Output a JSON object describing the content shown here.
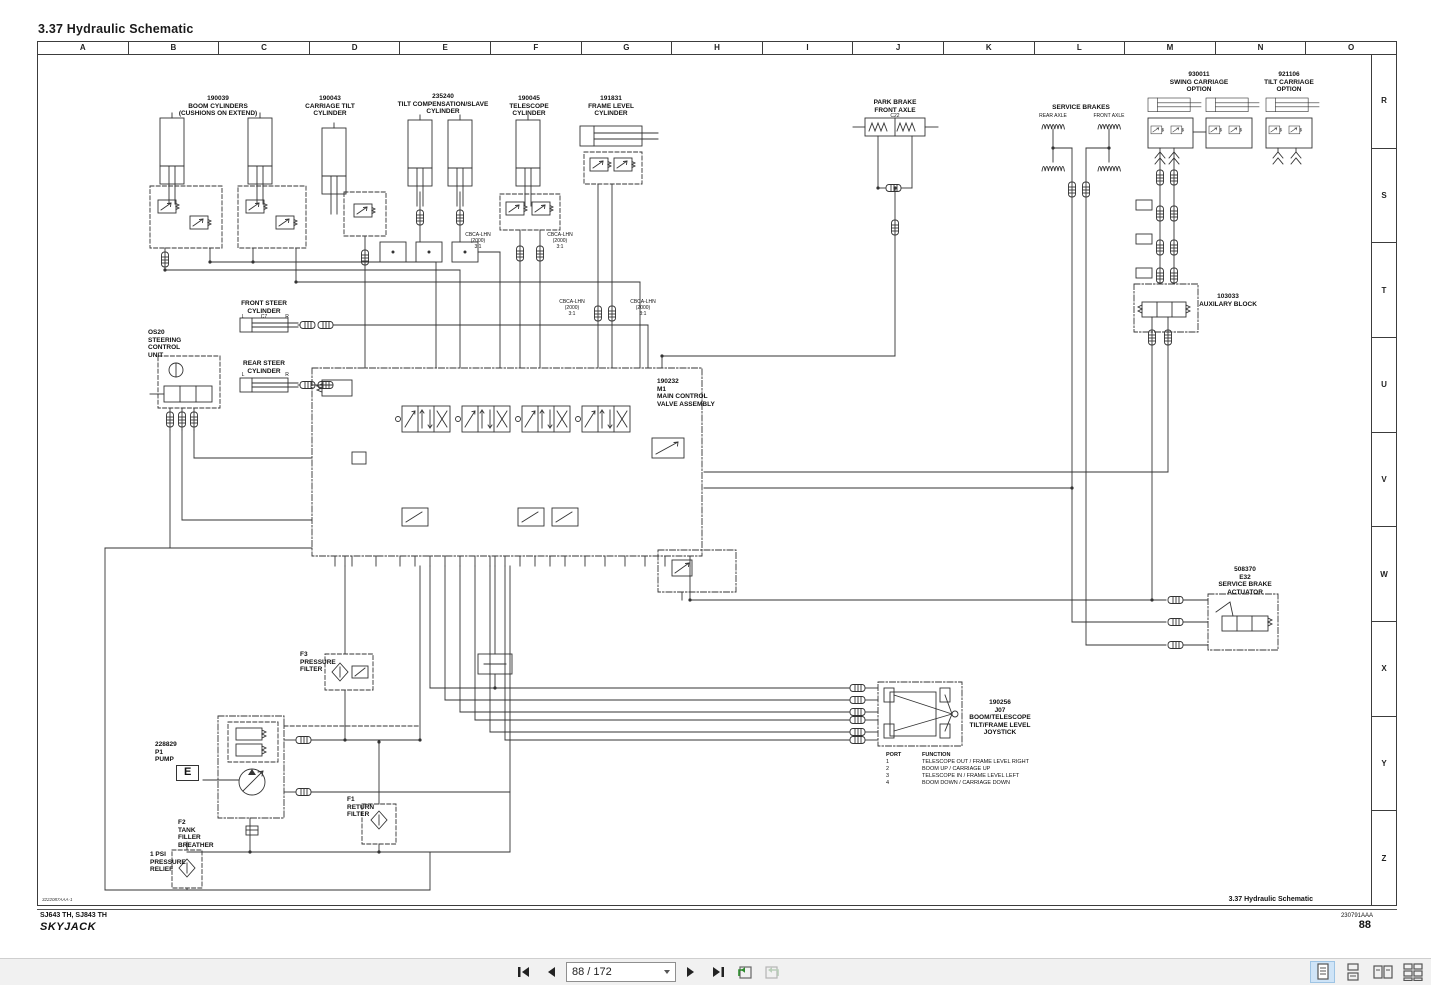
{
  "title": "3.37  Hydraulic Schematic",
  "grid": {
    "columns": [
      "A",
      "B",
      "C",
      "D",
      "E",
      "F",
      "G",
      "H",
      "I",
      "J",
      "K",
      "L",
      "M",
      "N",
      "O"
    ],
    "rows": [
      "R",
      "S",
      "T",
      "U",
      "V",
      "W",
      "X",
      "Y",
      "Z"
    ]
  },
  "components": [
    {
      "id": "boom-cylinders",
      "x": 218,
      "y": 95,
      "lines": [
        "190039",
        "BOOM CYLINDERS",
        "(CUSHIONS ON EXTEND)"
      ]
    },
    {
      "id": "carriage-tilt-cylinder",
      "x": 330,
      "y": 95,
      "lines": [
        "190043",
        "CARRIAGE TILT",
        "CYLINDER"
      ]
    },
    {
      "id": "tilt-compensation-cylinder",
      "x": 443,
      "y": 93,
      "lines": [
        "235240",
        "TILT COMPENSATION/SLAVE",
        "CYLINDER"
      ]
    },
    {
      "id": "telescope-cylinder",
      "x": 529,
      "y": 95,
      "lines": [
        "190045",
        "TELESCOPE",
        "CYLINDER"
      ]
    },
    {
      "id": "frame-level-cylinder",
      "x": 611,
      "y": 95,
      "lines": [
        "191831",
        "FRAME LEVEL",
        "CYLINDER"
      ]
    },
    {
      "id": "park-brake",
      "x": 895,
      "y": 99,
      "lines": [
        "PARK BRAKE",
        "FRONT AXLE"
      ]
    },
    {
      "id": "park-brake-port",
      "x": 895,
      "y": 113,
      "cls": "tiny",
      "lines": [
        "C22"
      ]
    },
    {
      "id": "service-brakes",
      "x": 1081,
      "y": 104,
      "lines": [
        "SERVICE BRAKES"
      ]
    },
    {
      "id": "service-brakes-rear-axle",
      "x": 1053,
      "y": 113,
      "cls": "tiny",
      "lines": [
        "REAR AXLE"
      ]
    },
    {
      "id": "service-brakes-front-axle",
      "x": 1109,
      "y": 113,
      "cls": "tiny",
      "lines": [
        "FRONT AXLE"
      ]
    },
    {
      "id": "swing-carriage-option",
      "x": 1199,
      "y": 71,
      "lines": [
        "930011",
        "SWING CARRIAGE",
        "OPTION"
      ]
    },
    {
      "id": "tilt-carriage-option",
      "x": 1289,
      "y": 71,
      "lines": [
        "921106",
        "TILT CARRIAGE",
        "OPTION"
      ]
    },
    {
      "id": "auxiliary-block",
      "x": 1228,
      "y": 293,
      "lines": [
        "103033",
        "AUXILARY BLOCK"
      ]
    },
    {
      "id": "service-brake-actuator",
      "x": 1245,
      "y": 566,
      "lines": [
        "508370",
        "E32",
        "SERVICE BRAKE",
        "ACTUATOR"
      ]
    },
    {
      "id": "joystick",
      "x": 1000,
      "y": 699,
      "lines": [
        "190256",
        "J07",
        "BOOM/TELESCOPE",
        "TILT/FRAME LEVEL",
        "JOYSTICK"
      ]
    },
    {
      "id": "pump",
      "x": 155,
      "y": 741,
      "align": "left",
      "lines": [
        "228829",
        "P1",
        "PUMP"
      ]
    },
    {
      "id": "pump-e-marker",
      "x": 176,
      "y": 765,
      "align": "left",
      "cls": "boxed",
      "lines": [
        "E"
      ]
    },
    {
      "id": "tank-filler-breather",
      "x": 178,
      "y": 819,
      "align": "left",
      "lines": [
        "F2",
        "TANK",
        "FILLER",
        "BREATHER"
      ]
    },
    {
      "id": "pressure-relief",
      "x": 150,
      "y": 851,
      "align": "left",
      "lines": [
        "1 PSI",
        "PRESSURE",
        "RELIEF"
      ]
    },
    {
      "id": "return-filter",
      "x": 347,
      "y": 796,
      "align": "left",
      "lines": [
        "F1",
        "RETURN",
        "FILTER"
      ]
    },
    {
      "id": "pressure-filter",
      "x": 300,
      "y": 651,
      "align": "left",
      "lines": [
        "F3",
        "PRESSURE",
        "FILTER"
      ]
    },
    {
      "id": "steering-control-unit",
      "x": 148,
      "y": 329,
      "align": "left",
      "lines": [
        "OS20",
        "STEERING",
        "CONTROL",
        "UNIT"
      ]
    },
    {
      "id": "front-steer-cylinder",
      "x": 264,
      "y": 300,
      "lines": [
        "FRONT STEER",
        "CYLINDER"
      ]
    },
    {
      "id": "rear-steer-cylinder",
      "x": 264,
      "y": 360,
      "lines": [
        "REAR STEER",
        "CYLINDER"
      ]
    },
    {
      "id": "main-control-valve",
      "x": 657,
      "y": 378,
      "align": "left",
      "lines": [
        "190232",
        "M1",
        "MAIN CONTROL",
        "VALVE ASSEMBLY"
      ]
    },
    {
      "id": "cb-note-telescope-left",
      "x": 478,
      "y": 232,
      "cls": "tiny",
      "lines": [
        "CBCA-LHN",
        "(2000)",
        "3:1"
      ]
    },
    {
      "id": "cb-note-telescope-right",
      "x": 560,
      "y": 232,
      "cls": "tiny",
      "lines": [
        "CBCA-LHN",
        "(2000)",
        "3:1"
      ]
    },
    {
      "id": "cb-note-frame-left",
      "x": 572,
      "y": 299,
      "cls": "tiny",
      "lines": [
        "CBCA-LHN",
        "(2000)",
        "3:1"
      ]
    },
    {
      "id": "cb-note-frame-right",
      "x": 643,
      "y": 299,
      "cls": "tiny",
      "lines": [
        "CBCA-LHN",
        "(2000)",
        "3:1"
      ]
    },
    {
      "id": "front-steer-port-l",
      "x": 243,
      "y": 314,
      "cls": "tiny",
      "lines": [
        "L"
      ]
    },
    {
      "id": "front-steer-port-c7",
      "x": 264,
      "y": 314,
      "cls": "tiny",
      "lines": [
        "C7"
      ]
    },
    {
      "id": "front-steer-port-r",
      "x": 287,
      "y": 314,
      "cls": "tiny",
      "lines": [
        "R"
      ]
    },
    {
      "id": "rear-steer-port-l",
      "x": 243,
      "y": 372,
      "cls": "tiny",
      "lines": [
        "L"
      ]
    },
    {
      "id": "rear-steer-port-r",
      "x": 287,
      "y": 372,
      "cls": "tiny",
      "lines": [
        "R"
      ]
    }
  ],
  "port_table": {
    "headers": [
      "PORT",
      "FUNCTION"
    ],
    "rows": [
      [
        "1",
        "TELESCOPE OUT / FRAME LEVEL RIGHT"
      ],
      [
        "2",
        "BOOM UP / CARRIAGE UP"
      ],
      [
        "3",
        "TELESCOPE IN / FRAME LEVEL LEFT"
      ],
      [
        "4",
        "BOOM DOWN / CARRIAGE DOWN"
      ]
    ]
  },
  "footer": {
    "drawing_code": "3222087AAA-1",
    "models": "SJ643 TH, SJ843 TH",
    "brand": "SKYJACK",
    "section_ref": "3.37  Hydraulic Schematic",
    "doc_number": "230791AAA",
    "page": "88"
  },
  "toolbar": {
    "page_indicator": "88 / 172"
  }
}
